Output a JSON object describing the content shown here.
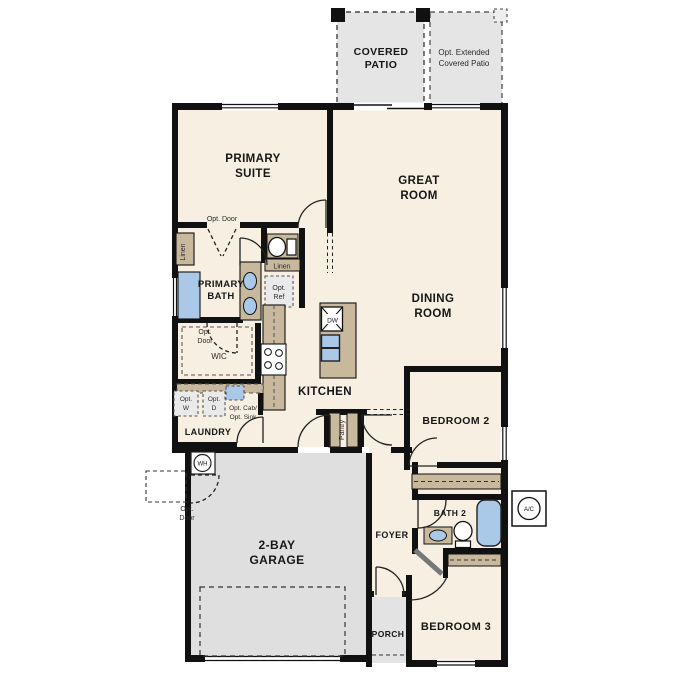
{
  "colors": {
    "room_fill": "#f7efe1",
    "patio_fill": "#e5e5e5",
    "garage_fill": "#dfdfdf",
    "wall": "#111111",
    "cabinet": "#c8b89c",
    "fixture_blue": "#aac9e8",
    "optional_box": "#eaeaea",
    "label": "#161616"
  },
  "labels": {
    "covered_patio": {
      "line1": "COVERED",
      "line2": "PATIO"
    },
    "opt_extended_patio": {
      "line1": "Opt. Extended",
      "line2": "Covered Patio"
    },
    "primary_suite": {
      "line1": "PRIMARY",
      "line2": "SUITE"
    },
    "great_room": {
      "line1": "GREAT",
      "line2": "ROOM"
    },
    "dining_room": {
      "line1": "DINING",
      "line2": "ROOM"
    },
    "primary_bath": {
      "line1": "PRIMARY",
      "line2": "BATH"
    },
    "opt_door_suite": "Opt. Door",
    "linen_left": "Linen",
    "linen_hall": "Linen",
    "opt_ref": {
      "line1": "Opt.",
      "line2": "Ref"
    },
    "wic": "WIC",
    "opt_door_wic": {
      "line1": "Opt.",
      "line2": "Door"
    },
    "kitchen": "KITCHEN",
    "dw": "DW",
    "pantry": "Pantry",
    "laundry": "LAUNDRY",
    "opt_w": {
      "line1": "Opt.",
      "line2": "W"
    },
    "opt_d": {
      "line1": "Opt.",
      "line2": "D"
    },
    "opt_cab_sink": {
      "line1": "Opt. Cab/",
      "line2": "Opt. Sink"
    },
    "wh": "WH",
    "opt_door_garage": {
      "line1": "Opt.",
      "line2": "Door"
    },
    "garage": {
      "line1": "2-BAY",
      "line2": "GARAGE"
    },
    "bedroom2": "BEDROOM 2",
    "bath2": "BATH 2",
    "ac": "A/C",
    "foyer": "FOYER",
    "porch": "PORCH",
    "bedroom3": "BEDROOM 3"
  }
}
